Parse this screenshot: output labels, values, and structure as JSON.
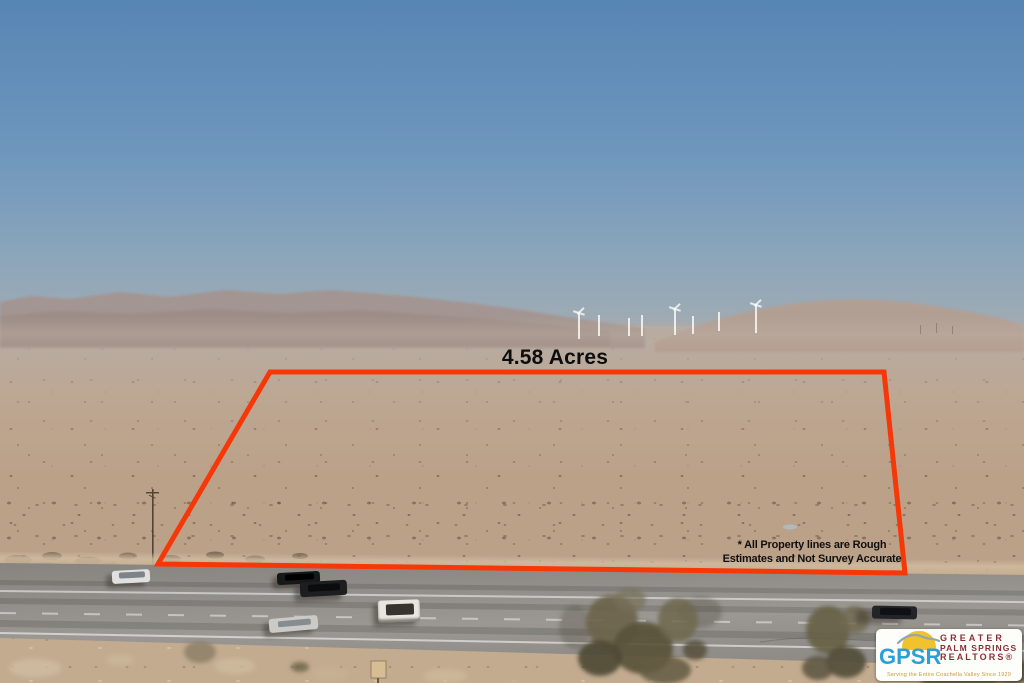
{
  "photo": {
    "acreage_label": "4.58 Acres",
    "disclaimer_line1": "* All Property lines are Rough",
    "disclaimer_line2": "Estimates and Not Survey Accurate",
    "outline": {
      "color": "#f63708",
      "points": "270,372 884,372 905,573 158,564",
      "stroke_width": 5
    }
  },
  "logo": {
    "abbr": "GPSR",
    "name_line1": "GREATER",
    "name_line2": "PALM SPRINGS",
    "name_line3": "REALTORS®",
    "tagline": "Serving the Entire Coachella Valley Since 1929",
    "colors": {
      "abbr": "#2d9fd8",
      "name": "#8b2f36",
      "sun": "#f2c12e",
      "bird": "#93a7b0",
      "tagline": "#c89b3c"
    }
  },
  "scene": {
    "colors": {
      "sky_top": "#5785b4",
      "sky_mid": "#6f97bd",
      "sky_low": "#8fa7ba",
      "sky_horizon": "#a6acb0",
      "desert_base": "#bca189",
      "road": "#908d89",
      "mountain_left": "#a5928c",
      "hill_right": "#b59e91"
    },
    "turbines": [
      {
        "x": 578,
        "y": 313,
        "h": 26,
        "rotor": true
      },
      {
        "x": 598,
        "y": 315,
        "h": 21,
        "rotor": false
      },
      {
        "x": 628,
        "y": 318,
        "h": 18,
        "rotor": false
      },
      {
        "x": 641,
        "y": 315,
        "h": 21,
        "rotor": false
      },
      {
        "x": 674,
        "y": 309,
        "h": 26,
        "rotor": true
      },
      {
        "x": 692,
        "y": 316,
        "h": 18,
        "rotor": false
      },
      {
        "x": 718,
        "y": 312,
        "h": 19,
        "rotor": false
      },
      {
        "x": 755,
        "y": 305,
        "h": 28,
        "rotor": true
      }
    ],
    "vehicles": [
      {
        "name": "white-sedan-left",
        "x": 112,
        "y": 570,
        "w": 38,
        "h": 13,
        "angle": -3,
        "body": "#e0e1df",
        "roof": "#7d8489",
        "roof_frac": 0.45,
        "shadow": "-6px 4px 4px rgba(45,38,30,.4)"
      },
      {
        "name": "black-sedan",
        "x": 277,
        "y": 572,
        "w": 43,
        "h": 12,
        "angle": -3,
        "body": "#17181a",
        "roof": "#000000",
        "roof_frac": 0.5,
        "shadow": "-5px 4px 4px rgba(45,38,30,.45)"
      },
      {
        "name": "black-pickup",
        "x": 300,
        "y": 581,
        "w": 47,
        "h": 15,
        "angle": -3,
        "body": "#1d1e20",
        "roof": "#0b0c0e",
        "roof_frac": 0.5,
        "shadow": "-6px 5px 5px rgba(45,38,30,.45)"
      },
      {
        "name": "silver-sedan",
        "x": 269,
        "y": 617,
        "w": 49,
        "h": 14,
        "angle": -5,
        "body": "#cacac7",
        "roof": "#878c91",
        "roof_frac": 0.48,
        "shadow": "-6px 4px 4px rgba(45,38,30,.4)"
      },
      {
        "name": "white-suv",
        "x": 378,
        "y": 600,
        "w": 42,
        "h": 22,
        "angle": -2,
        "body": "#e9e6df",
        "roof": "#35342f",
        "roof_frac": 0.5,
        "shadow": "-5px 4px 5px rgba(45,38,30,.45), inset 0 -3px 2px rgba(30,30,28,.5)"
      },
      {
        "name": "dark-car-right",
        "x": 872,
        "y": 606,
        "w": 45,
        "h": 13,
        "angle": 1,
        "body": "#232427",
        "roof": "#101114",
        "roof_frac": 0.5,
        "shadow": "-16px 5px 6px rgba(50,44,36,.45)"
      }
    ]
  }
}
